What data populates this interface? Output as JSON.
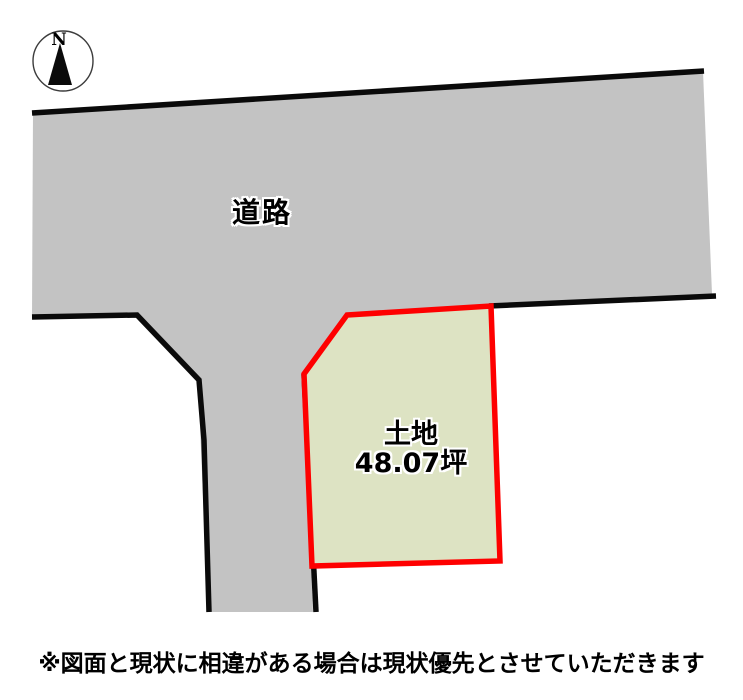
{
  "compass": {
    "label": "N"
  },
  "road": {
    "label": "道路"
  },
  "parcel": {
    "name_label": "土地",
    "area_label": "48.07坪"
  },
  "footer": {
    "disclaimer": "※図面と現状に相違がある場合は現状優先とさせていただきます"
  },
  "colors": {
    "road_fill": "#c3c3c3",
    "outline_black": "#0a0a0a",
    "parcel_fill": "#dde3c3",
    "parcel_border": "#fe0000",
    "label_text": "#000000",
    "label_halo": "#ffffff",
    "page_bg": "#ffffff"
  }
}
